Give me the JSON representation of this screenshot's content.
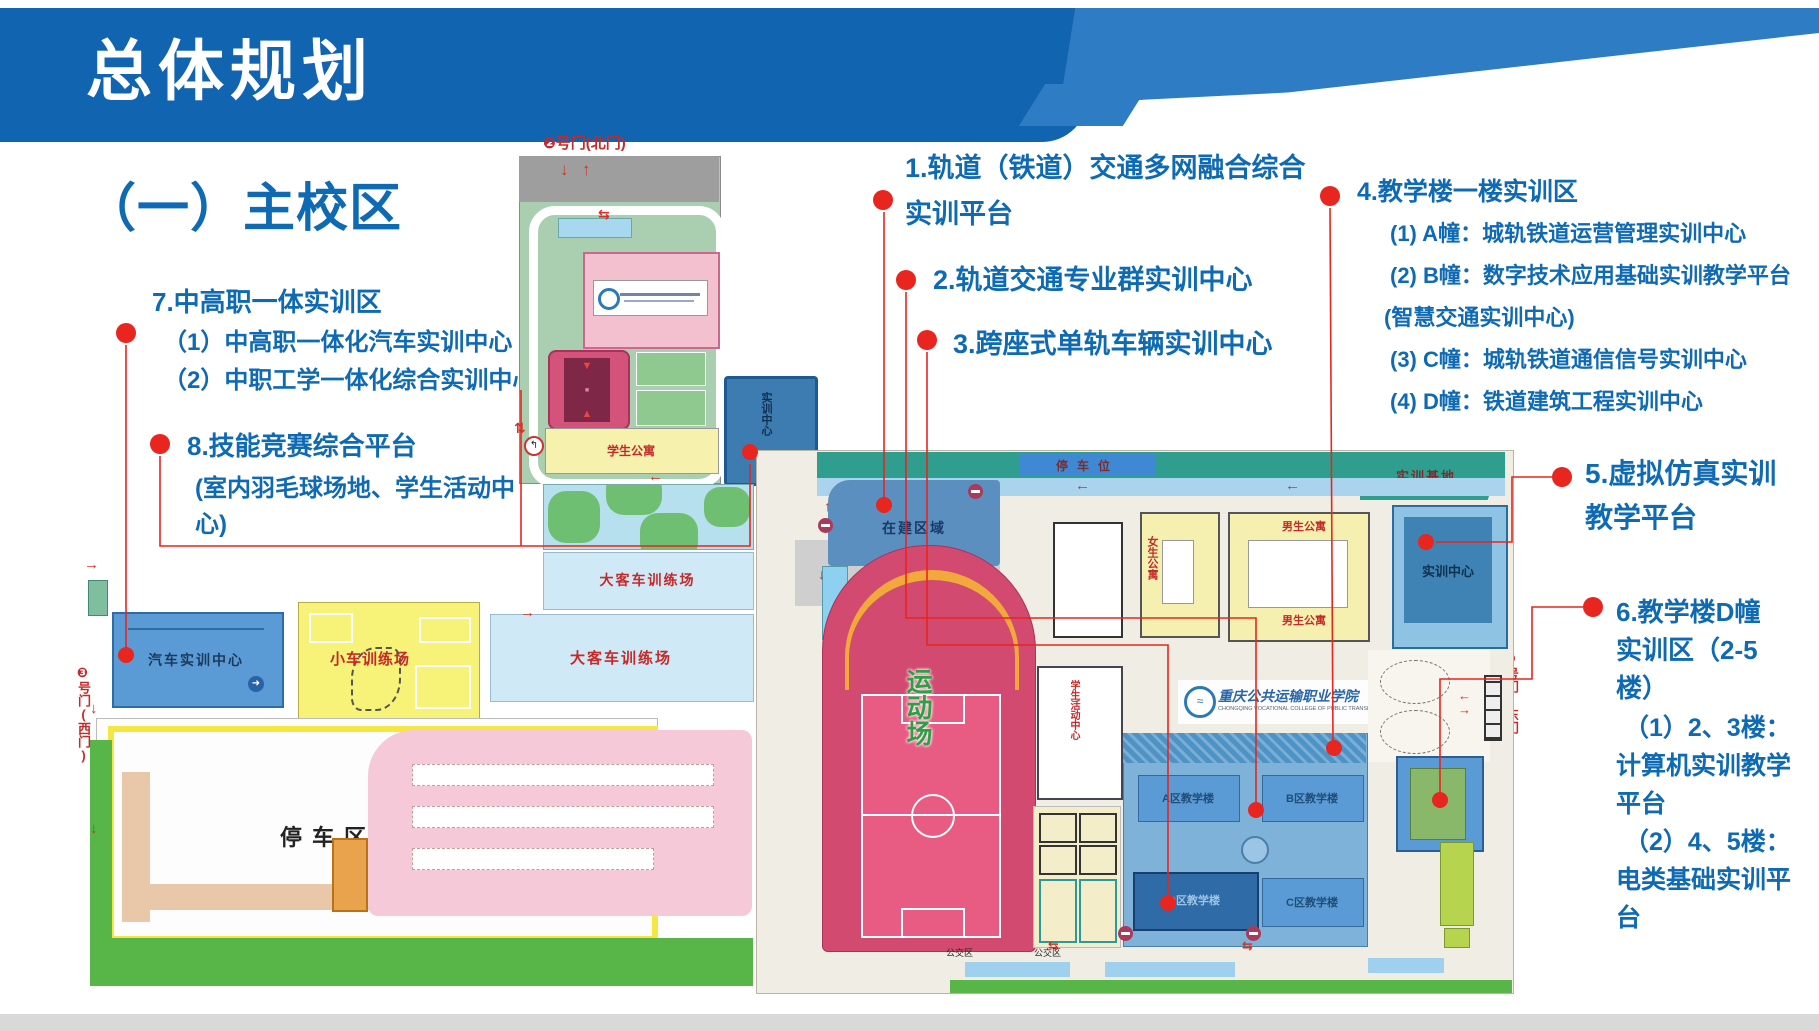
{
  "colors": {
    "banner_blue": "#1164af",
    "swoosh_blue": "#2e7cc3",
    "annotation_blue": "#0f6ab4",
    "marker_red": "#e8251f",
    "map_label_red": "#c42a2a"
  },
  "header": {
    "title": "总体规划"
  },
  "section": {
    "title": "（一）主校区"
  },
  "annotations": {
    "a1": {
      "line1": "1.轨道（铁道）交通多网融合综合",
      "line2": "实训平台"
    },
    "a2": {
      "text": "2.轨道交通专业群实训中心"
    },
    "a3": {
      "text": "3.跨座式单轨车辆实训中心"
    },
    "a4": {
      "title": "4.教学楼一楼实训区",
      "items": [
        "(1) A幢：城轨铁道运营管理实训中心",
        "(2) B幢：数字技术应用基础实训教学平台",
        "(智慧交通实训中心)",
        "(3) C幢：城轨铁道通信信号实训中心",
        "(4) D幢：铁道建筑工程实训中心"
      ]
    },
    "a5": {
      "line1": "5.虚拟仿真实训",
      "line2": "教学平台"
    },
    "a6": {
      "lines": [
        "6.教学楼D幢",
        "实训区（2-5",
        "楼）",
        "（1）2、3楼：",
        "计算机实训教学",
        "平台",
        "（2）4、5楼：",
        "电类基础实训平",
        "台"
      ]
    },
    "a7": {
      "title": "7.中高职一体实训区",
      "items": [
        "（1）中高职一体化汽车实训中心",
        "（2）中职工学一体化综合实训中心"
      ]
    },
    "a8": {
      "title": "8.技能竞赛综合平台",
      "sub1": "(室内羽毛球场地、学生活动中",
      "sub2": "心)"
    }
  },
  "map": {
    "gates": {
      "north": "❷号门(北门)",
      "west": "❸号门(西门)",
      "east": "❶号门(东门)"
    },
    "left": {
      "student_dorm": "学生公寓",
      "bus_field_1": "大客车训练场",
      "bus_field_2": "大客车训练场",
      "car_field": "小车训练场",
      "auto_center": "汽车实训中心",
      "parking_zone": "停车区",
      "training_center": "实训中心"
    },
    "right": {
      "construction": "在建区域",
      "parking_spots": "停车位",
      "training_base": "实训基地",
      "training_center": "实训中心",
      "stadium": "运动场",
      "girls_dorm": "女生公寓",
      "boys_dorm_1": "男生公寓",
      "boys_dorm_2": "男生公寓",
      "activity_center": "学生活动中心",
      "bldg_a": "A区教学楼",
      "bldg_b": "B区教学楼",
      "bldg_c": "C区教学楼",
      "bldg_d": "D区教学楼",
      "bus_zone_1": "公交区",
      "bus_zone_2": "公交区",
      "college_name": "重庆公共运输职业学院",
      "college_name_en": "CHONGQING VOCATIONAL COLLEGE OF PUBLIC TRANSPORTATION"
    }
  }
}
